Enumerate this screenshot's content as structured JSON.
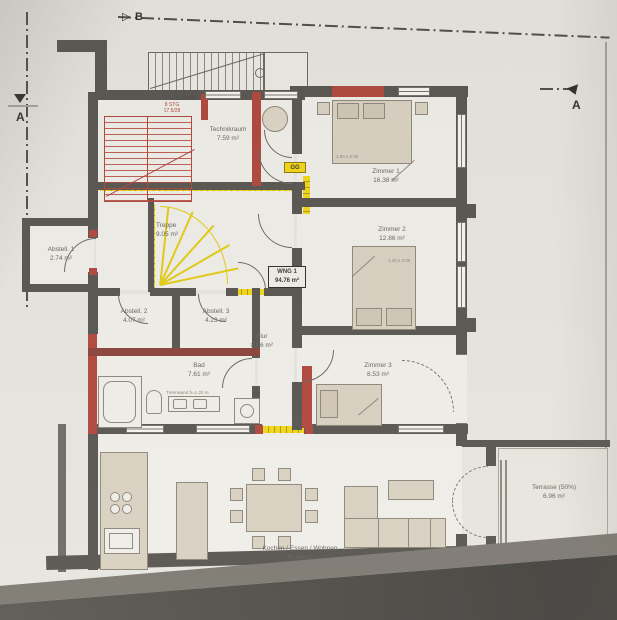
{
  "plan": {
    "apartment": {
      "id": "WNG 1",
      "area": "94.76 m²"
    },
    "rooms": [
      {
        "name": "Technikraum",
        "area": "7.59 m²"
      },
      {
        "name": "Treppe",
        "area": "9.05 m²"
      },
      {
        "name": "Abstell. 1",
        "area": "2.74 m²"
      },
      {
        "name": "Abstell. 2",
        "area": "4.07 m²"
      },
      {
        "name": "Abstell. 3",
        "area": "4.23 m²"
      },
      {
        "name": "Flur",
        "area": "8.06 m²"
      },
      {
        "name": "Bad",
        "area": "7.61 m²"
      },
      {
        "name": "Zimmer 1",
        "area": "16.38 m²"
      },
      {
        "name": "Zimmer 2",
        "area": "12.86 m²"
      },
      {
        "name": "Zimmer 3",
        "area": "8.53 m²"
      },
      {
        "name": "Kochen / Essen / Wohnen",
        "area": "41.84 m²"
      },
      {
        "name": "Terrasse (50%)",
        "area": "6.96 m²"
      }
    ],
    "annotations": {
      "level": "6.180 ÜK",
      "stair_line1": "8 STG",
      "stair_line2": "17.5/28",
      "wall_mark": "GG",
      "partition": "Trennwand h=1.20 m",
      "bed1": "1.80 x 2.00",
      "bed2": "1.40 x 2.00"
    },
    "markers": {
      "left": "A",
      "right": "A",
      "top": "B"
    },
    "colors": {
      "wall": "#57544f",
      "accent_red": "#b0453c",
      "accent_yellow": "#f2d714",
      "furniture": "#d9d1c1",
      "paper": "#e7e5df"
    }
  }
}
